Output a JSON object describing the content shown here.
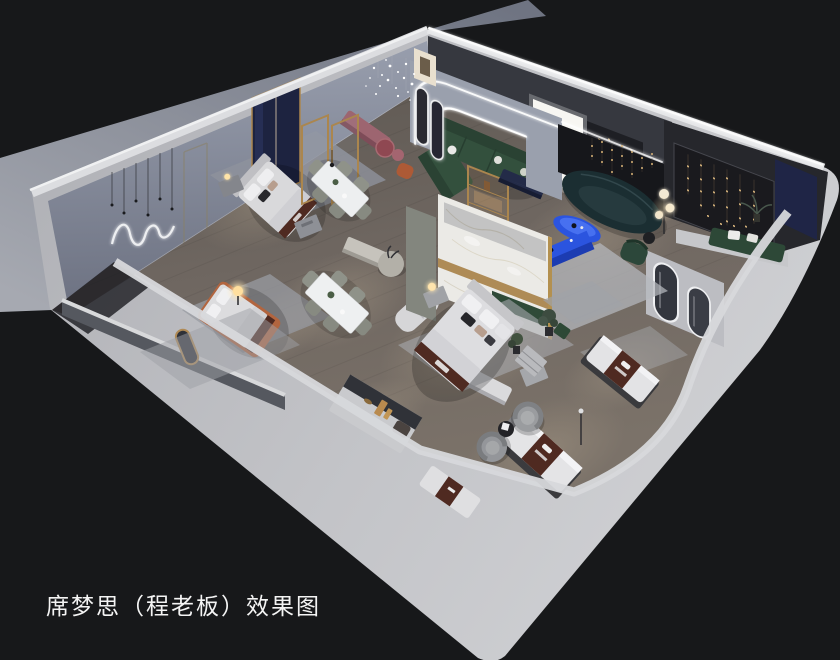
{
  "caption": {
    "text": "席梦思（程老板）效果图"
  },
  "palette": {
    "bg": "#17181a",
    "ground-top": "#747988",
    "ground-bottom": "#a6a9b1",
    "wall-light": "#bfc0c5",
    "wall-top": "#dcdde0",
    "interior-wall": "#8f94a2",
    "floor-dark": "#605954",
    "floor-light": "#7e756d",
    "rug": "#a9acb2",
    "marble": "#ebeae6",
    "gold": "#ab864e",
    "accent-blue": "#2b54df",
    "sofa-green": "#33503d",
    "sofa-teal": "#1b2e32",
    "mauve": "#9d6570",
    "runner-brown": "#4f2a21",
    "terracotta": "#b2653f",
    "navy": "#1f2546",
    "warm-light": "#f4dda4",
    "bedding": "#dcdcde",
    "caption-color": "#f4f4f4"
  },
  "scene": {
    "description": "isometric cutaway 3D render of a mattress showroom interior"
  }
}
